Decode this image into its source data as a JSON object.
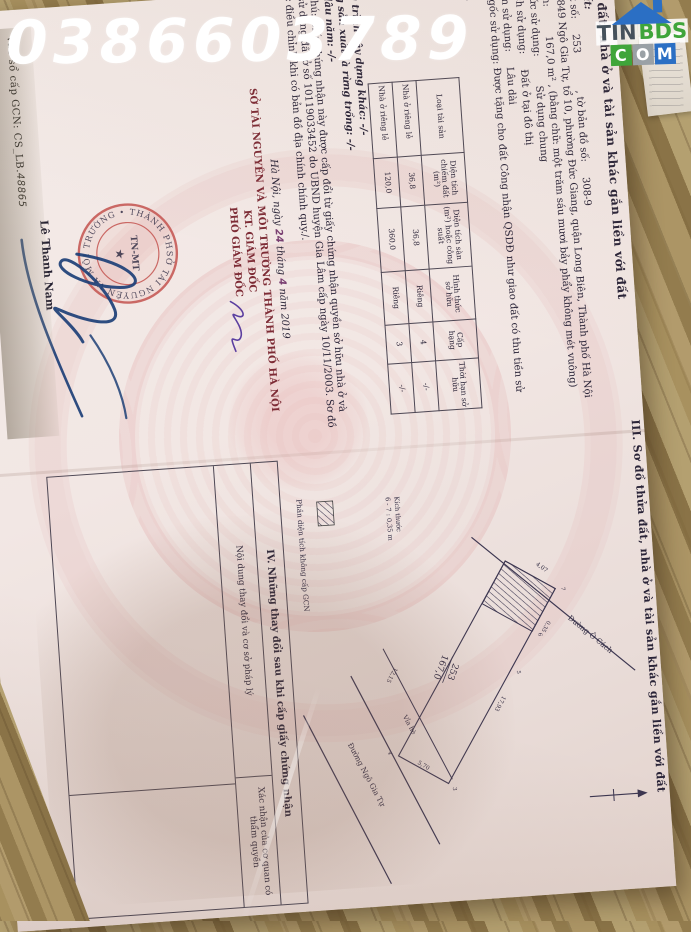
{
  "watermark": {
    "phone": "0386603789"
  },
  "logo": {
    "part_dark": "TIN",
    "part_green": "BDS",
    "c": "C",
    "o": "O",
    "m": "M"
  },
  "certificate": {
    "serial_label": "vào sổ cấp GCN: CS_LB.",
    "serial_number": "48865",
    "section2": {
      "header": "II. Thửa đất, nhà ở và tài sản khác gắn liền với đất",
      "item1_title": "1. Thửa đất:",
      "a_label": "a) Thửa đất số:",
      "a_value": "253",
      "a_label2": ", tờ bản đồ số:",
      "a_value2": "308-9",
      "b": "b) Địa chỉ: 849 Ngô Gia Tự, tổ 10, phường Đức Giang, quận Long Biên, Thành phố Hà Nội",
      "c_label": "c) Diện tích:",
      "c_value": "167,0 m²",
      "c_words": ", (bằng chữ: một trăm sáu mươi bảy phẩy không mét vuông)",
      "d_label": "d) Hình thức sử dụng:",
      "d_value": "Sử dụng chung",
      "dd_label": "đ) Mục đích sử dụng:",
      "dd_value": "Đất ở tại đô thị",
      "e_label": "e) Thời hạn sử dụng:",
      "e_value": "Lâu dài",
      "g": "g) Nguồn gốc sử dụng: Được tặng cho đất Công nhận QSDĐ như giao đất có thu tiền sử dụng đất",
      "item2_title": "2. Nhà ở:",
      "house_table": {
        "headers": [
          "Loại tài sản",
          "Diện tích chiếm đất (m²)",
          "Diện tích sàn (m²) hoặc công suất",
          "Hình thức sở hữu",
          "Cấp hạng",
          "Thời hạn sở hữu"
        ],
        "rows": [
          [
            "Nhà ở riêng lẻ",
            "36,8",
            "36,8",
            "Riêng",
            "4",
            "-/-"
          ],
          [
            "Nhà ở riêng lẻ",
            "120,0",
            "360,0",
            "Riêng",
            "3",
            "-/-"
          ]
        ]
      },
      "item3": "3. Công trình xây dựng khác: -/-",
      "item4": "4. Rừng sản xuất là rừng trồng: -/-",
      "item5": "5. Cây lâu năm: -/-",
      "item6": "6. Ghi chú: Giấy chứng nhận này được cấp đổi từ giấy chứng nhận quyền sở hữu nhà ở và quyền sử dụng đất ở số 10119033452 do UBND huyện Gia Lâm cấp ngày 10/11/2003. Sơ đồ sẽ được điều chỉnh khi có bản đồ địa chính chính quy./."
    },
    "signing": {
      "date_pre": "Hà Nội, ngày",
      "day": "24",
      "date_mid1": "tháng",
      "month": "4",
      "date_mid2": "năm",
      "year": "2019",
      "agency": "SỞ TÀI NGUYÊN VÀ MÔI TRƯỜNG THÀNH PHỐ HÀ NỘI",
      "kt": "KT. GIÁM ĐỐC",
      "deputy": "PHÓ GIÁM ĐỐC",
      "signer": "Lê Thanh Nam",
      "seal_ring_text": "SỞ TÀI NGUYÊN VÀ MÔI TRƯỜNG • THÀNH PHỐ HÀ NỘI •",
      "seal_center": "TN-MT"
    },
    "section3": {
      "header": "III. Sơ đồ thửa đất, nhà ở và tài sản khác gắn liền với đất",
      "diagram": {
        "plot_number": "253",
        "plot_area": "167,0",
        "road_top": "Đường Ô Cách",
        "road_bottom": "Đường Ngô Gia Tự",
        "sidewalk": "Vỉa hè",
        "dims": {
          "d1": "17,93",
          "d2": "12,15",
          "d3": "5,70",
          "d4": "4,07",
          "d5": "0,35"
        },
        "vertices": [
          "3",
          "4",
          "5",
          "6",
          "7"
        ],
        "note_line1": "Kích thước",
        "note_line2": "6 - 7 : 0,35 m",
        "legend": "Phần diện tích không cấp GCN"
      }
    },
    "section4": {
      "title": "IV. Những thay đổi sau khi cấp giấy chứng nhận",
      "col1": "Nội dung thay đổi và cơ sở pháp lý",
      "col2": "Xác nhận của cơ quan có thẩm quyền"
    }
  }
}
